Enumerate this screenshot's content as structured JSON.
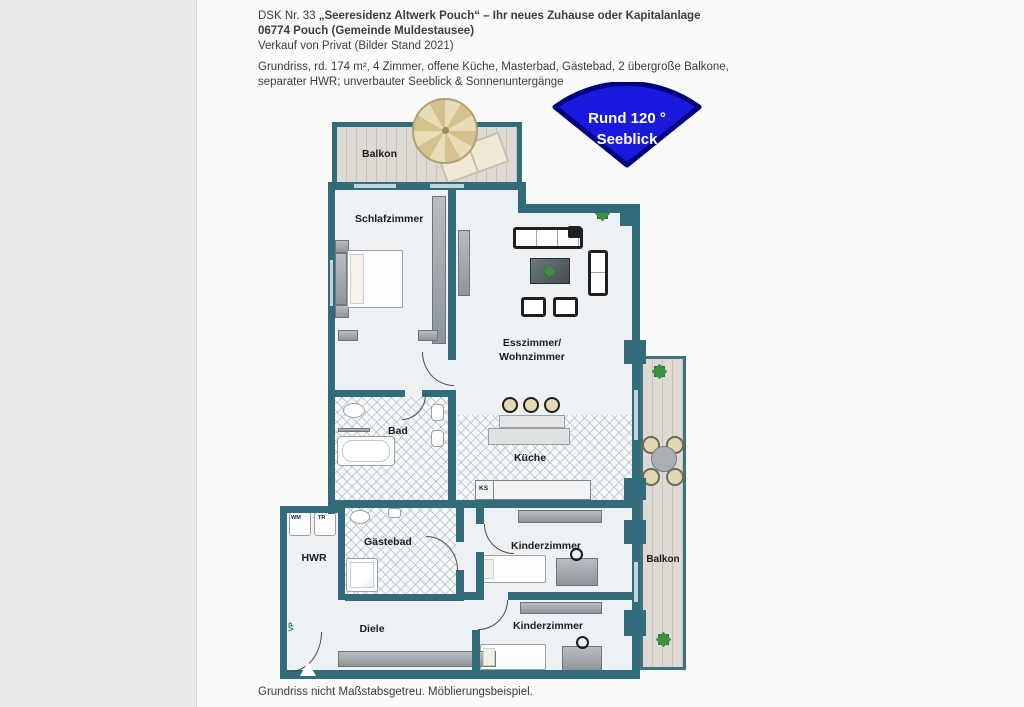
{
  "header": {
    "line1_prefix": "DSK Nr. 33 ",
    "line1_bold": "„Seeresidenz Altwerk Pouch“ – Ihr neues Zuhause oder Kapitalanlage",
    "line2": "06774 Pouch (Gemeinde Muldestausee)",
    "line3": "Verkauf von Privat (Bilder Stand 2021)",
    "description_line1": "Grundriss, rd. 174 m², 4 Zimmer, offene Küche, Masterbad, Gästebad, 2 übergroße Balkone,",
    "description_line2": "separater HWR; unverbauter Seeblick & Sonnenuntergänge"
  },
  "badge": {
    "line1": "Rund 120 °",
    "line2": "Seeblick",
    "fill_color": "#1a1adf",
    "border_color": "#00007e",
    "text_color": "#ffffff"
  },
  "floorplan": {
    "wall_color": "#326b79",
    "labels": {
      "balkon_top": "Balkon",
      "schlafzimmer": "Schlafzimmer",
      "wohnzimmer_line1": "Esszimmer/",
      "wohnzimmer_line2": "Wohnzimmer",
      "bad": "Bad",
      "kueche": "Küche",
      "gaestebad": "Gästebad",
      "hwr": "HWR",
      "kinderzimmer_1": "Kinderzimmer",
      "kinderzimmer_2": "Kinderzimmer",
      "diele": "Diele",
      "balkon_right": "Balkon",
      "ks": "KS",
      "wm": "WM",
      "tr": "TR"
    },
    "watermark": "VP"
  },
  "footer": {
    "note": "Grundriss nicht Maßstabsgetreu. Möblierungsbeispiel."
  }
}
